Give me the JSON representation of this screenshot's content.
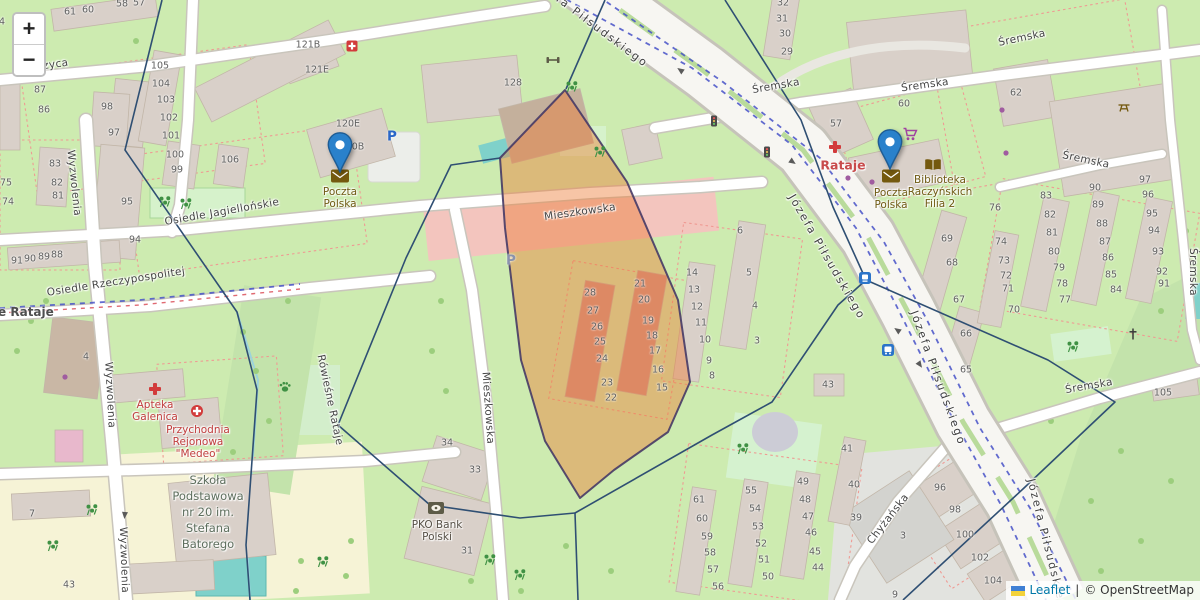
{
  "zoom_control": {
    "zoom_in": "+",
    "zoom_out": "−"
  },
  "attribution": {
    "flag_icon": "ukraine-flag-icon",
    "leaflet_link": "Leaflet",
    "separator": "|",
    "copyright": "© OpenStreetMap"
  },
  "colors": {
    "marker_blue": "#2A81CB",
    "highlight_polygon_fill": "#ed7f3a",
    "highlight_polygon_stroke": "#463a66",
    "base_green": "#cdebb0",
    "building_tan": "#d9d0c9",
    "tram_dash_blue": "#4752c8",
    "boundary_navy": "#2f4f73",
    "amenity_brown": "#6f5a13",
    "medical_red": "#c03d3d"
  },
  "markers": [
    {
      "name": "poczta-polska-marker-west",
      "label": "Poczta Polska",
      "x": 340,
      "y": 173
    },
    {
      "name": "poczta-polska-marker-east",
      "label": "Poczta Polska",
      "x": 890,
      "y": 170
    }
  ],
  "street_labels": [
    [
      "Józefa Piłsudskiego",
      590,
      22,
      37,
      "maj"
    ],
    [
      "Józefa Piłsudskiego",
      827,
      257,
      60,
      "maj"
    ],
    [
      "Józefa Piłsudskiego",
      938,
      378,
      70,
      "maj"
    ],
    [
      "Józefa Piłsudskiego",
      1048,
      548,
      76,
      "maj"
    ],
    [
      "Śremska",
      776,
      86,
      -10
    ],
    [
      "Śremska",
      925,
      85,
      -8
    ],
    [
      "Śremska",
      1022,
      38,
      -12
    ],
    [
      "Śremska",
      1086,
      160,
      12
    ],
    [
      "Śremska",
      1089,
      386,
      -10
    ],
    [
      "Śremska",
      1193,
      272,
      90
    ],
    [
      "Mieszkowska",
      580,
      212,
      -8
    ],
    [
      "Mieszkowska",
      488,
      408,
      86
    ],
    [
      "Osiedle Jagiellońskie",
      222,
      212,
      -10
    ],
    [
      "Osiedle Rzeczypospolitej",
      116,
      282,
      -9
    ],
    [
      "Wyzwolenia",
      74,
      183,
      84
    ],
    [
      "Wyzwolenia",
      110,
      395,
      87
    ],
    [
      "Wyzwolenia",
      124,
      560,
      88
    ],
    [
      "Ostrzyca",
      44,
      66,
      -8
    ],
    [
      "Chyżańska",
      888,
      519,
      -52
    ],
    [
      "Rówieśne Rataje",
      330,
      400,
      78
    ]
  ],
  "place_labels": [
    {
      "text": "Rataje",
      "x": 843,
      "y": 165,
      "cls": "suburb-red"
    },
    {
      "text": "ve Rataje",
      "x": 22,
      "y": 312,
      "cls": "suburb-gray"
    }
  ],
  "poi_labels": [
    {
      "name": "poczta-polska-label-west",
      "lines": [
        "Poczta",
        "Polska"
      ],
      "x": 340,
      "y": 186,
      "cls": "amenity"
    },
    {
      "name": "poczta-polska-label-east",
      "lines": [
        "Poczta",
        "Polska"
      ],
      "x": 891,
      "y": 187,
      "cls": "amenity"
    },
    {
      "name": "biblioteka-label",
      "lines": [
        "Biblioteka",
        "Raczyńskich",
        "Filia 2"
      ],
      "x": 940,
      "y": 174,
      "cls": "amenity"
    },
    {
      "name": "apteka-label",
      "lines": [
        "Apteka",
        "Galenica"
      ],
      "x": 155,
      "y": 399,
      "cls": "medical"
    },
    {
      "name": "przychodnia-label",
      "lines": [
        "Przychodnia",
        "Rejonowa",
        "\"Medeo\""
      ],
      "x": 198,
      "y": 424,
      "cls": "medical"
    },
    {
      "name": "pko-bank-label",
      "lines": [
        "PKO Bank",
        "Polski"
      ],
      "x": 437,
      "y": 519,
      "cls": "bank"
    },
    {
      "name": "school-label",
      "lines": [
        "Szkoła",
        "Podstawowa",
        "nr 20 im.",
        "Stefana",
        "Batorego"
      ],
      "x": 208,
      "y": 472,
      "cls": "school"
    }
  ],
  "icons": [
    {
      "type": "pharmacy",
      "name": "pharmacy-icon",
      "x": 155,
      "y": 389
    },
    {
      "type": "doctors",
      "name": "doctors-icon",
      "x": 197,
      "y": 411
    },
    {
      "type": "pharmacy",
      "name": "pharmacy-icon",
      "x": 835,
      "y": 147
    },
    {
      "type": "supermarket",
      "name": "supermarket-cart-icon",
      "x": 910,
      "y": 134
    },
    {
      "type": "library",
      "name": "library-book-icon",
      "x": 933,
      "y": 165
    },
    {
      "type": "bank",
      "name": "bank-icon",
      "x": 436,
      "y": 508
    },
    {
      "type": "post",
      "name": "post-envelope-icon",
      "x": 340,
      "y": 176
    },
    {
      "type": "post",
      "name": "post-envelope-icon",
      "x": 891,
      "y": 176
    },
    {
      "type": "tram",
      "name": "tram-stop-icon",
      "x": 865,
      "y": 278
    },
    {
      "type": "bus",
      "name": "bus-stop-icon",
      "x": 888,
      "y": 350
    },
    {
      "type": "traffic",
      "name": "traffic-light-icon",
      "x": 714,
      "y": 121
    },
    {
      "type": "traffic",
      "name": "traffic-light-icon",
      "x": 767,
      "y": 152
    },
    {
      "type": "cross",
      "name": "wayside-cross-icon",
      "x": 1133,
      "y": 334
    },
    {
      "type": "picnic",
      "name": "picnic-table-icon",
      "x": 1124,
      "y": 107
    },
    {
      "type": "fitness",
      "name": "fitness-icon",
      "x": 553,
      "y": 60
    },
    {
      "type": "redpoi",
      "name": "fire-station-icon",
      "x": 352,
      "y": 46
    },
    {
      "type": "dogpark",
      "name": "dog-park-paw-icon",
      "x": 285,
      "y": 387
    },
    {
      "type": "playground",
      "name": "playground-icon",
      "x": 165,
      "y": 202
    },
    {
      "type": "playground",
      "name": "playground-icon",
      "x": 186,
      "y": 204
    },
    {
      "type": "playground",
      "name": "playground-icon",
      "x": 600,
      "y": 152
    },
    {
      "type": "playground",
      "name": "playground-icon",
      "x": 572,
      "y": 87
    },
    {
      "type": "playground",
      "name": "playground-icon",
      "x": 92,
      "y": 510
    },
    {
      "type": "playground",
      "name": "playground-icon",
      "x": 53,
      "y": 546
    },
    {
      "type": "playground",
      "name": "playground-icon",
      "x": 743,
      "y": 449
    },
    {
      "type": "playground",
      "name": "playground-icon",
      "x": 1073,
      "y": 347
    },
    {
      "type": "playground",
      "name": "playground-icon",
      "x": 323,
      "y": 562
    },
    {
      "type": "playground",
      "name": "playground-icon",
      "x": 490,
      "y": 560
    },
    {
      "type": "playground",
      "name": "playground-icon",
      "x": 520,
      "y": 575
    },
    {
      "type": "shopdot",
      "name": "shop-dot-icon",
      "x": 848,
      "y": 178
    },
    {
      "type": "shopdot",
      "name": "shop-dot-icon",
      "x": 872,
      "y": 182
    },
    {
      "type": "shopdot",
      "name": "shop-dot-icon",
      "x": 1002,
      "y": 110
    },
    {
      "type": "shopdot",
      "name": "shop-dot-icon",
      "x": 1006,
      "y": 153
    },
    {
      "type": "shopdot",
      "name": "shop-dot-icon",
      "x": 65,
      "y": 377
    }
  ],
  "text_icons": [
    {
      "name": "parking-icon",
      "glyph": "P",
      "x": 392,
      "y": 137,
      "color": "#2a66c8"
    },
    {
      "name": "parking-icon",
      "glyph": "P",
      "x": 511,
      "y": 261,
      "color": "#8a93ad"
    }
  ],
  "building_numbers": [
    [
      "4",
      2,
      22
    ],
    [
      "61",
      70,
      12
    ],
    [
      "60",
      88,
      10
    ],
    [
      "58",
      122,
      4
    ],
    [
      "57",
      139,
      3
    ],
    [
      "87",
      40,
      90
    ],
    [
      "86",
      44,
      110
    ],
    [
      "98",
      107,
      107
    ],
    [
      "97",
      114,
      133
    ],
    [
      "105",
      160,
      66
    ],
    [
      "104",
      161,
      84
    ],
    [
      "103",
      166,
      100
    ],
    [
      "102",
      169,
      118
    ],
    [
      "101",
      171,
      136
    ],
    [
      "121B",
      308,
      45
    ],
    [
      "121E",
      317,
      70
    ],
    [
      "120E",
      348,
      124
    ],
    [
      "120B",
      352,
      147
    ],
    [
      "128",
      513,
      83
    ],
    [
      "83",
      55,
      164
    ],
    [
      "82",
      57,
      183
    ],
    [
      "81",
      58,
      196
    ],
    [
      "75",
      6,
      183
    ],
    [
      "74",
      8,
      202
    ],
    [
      "100",
      175,
      155
    ],
    [
      "99",
      177,
      170
    ],
    [
      "106",
      230,
      160
    ],
    [
      "95",
      127,
      202
    ],
    [
      "94",
      135,
      240
    ],
    [
      "91",
      17,
      261
    ],
    [
      "90",
      30,
      259
    ],
    [
      "89",
      44,
      257
    ],
    [
      "88",
      57,
      255
    ],
    [
      "7",
      32,
      514
    ],
    [
      "43",
      69,
      585
    ],
    [
      "4",
      86,
      357
    ],
    [
      "34",
      447,
      443
    ],
    [
      "33",
      475,
      470
    ],
    [
      "31",
      467,
      551
    ],
    [
      "28",
      590,
      293
    ],
    [
      "27",
      593,
      311
    ],
    [
      "26",
      597,
      327
    ],
    [
      "25",
      600,
      342
    ],
    [
      "24",
      602,
      359
    ],
    [
      "23",
      607,
      383
    ],
    [
      "22",
      611,
      398
    ],
    [
      "21",
      640,
      284
    ],
    [
      "20",
      644,
      300
    ],
    [
      "19",
      648,
      321
    ],
    [
      "18",
      652,
      336
    ],
    [
      "17",
      655,
      351
    ],
    [
      "16",
      658,
      370
    ],
    [
      "15",
      662,
      388
    ],
    [
      "14",
      692,
      273
    ],
    [
      "13",
      694,
      290
    ],
    [
      "12",
      697,
      307
    ],
    [
      "11",
      701,
      323
    ],
    [
      "10",
      705,
      340
    ],
    [
      "9",
      709,
      361
    ],
    [
      "8",
      712,
      376
    ],
    [
      "6",
      740,
      231
    ],
    [
      "5",
      749,
      273
    ],
    [
      "4",
      755,
      306
    ],
    [
      "3",
      757,
      341
    ],
    [
      "43",
      828,
      385
    ],
    [
      "61",
      699,
      500
    ],
    [
      "60",
      702,
      519
    ],
    [
      "59",
      707,
      537
    ],
    [
      "58",
      710,
      553
    ],
    [
      "57",
      713,
      570
    ],
    [
      "56",
      718,
      587
    ],
    [
      "55",
      751,
      491
    ],
    [
      "54",
      755,
      509
    ],
    [
      "53",
      758,
      527
    ],
    [
      "52",
      761,
      544
    ],
    [
      "51",
      764,
      560
    ],
    [
      "50",
      768,
      577
    ],
    [
      "49",
      803,
      482
    ],
    [
      "48",
      805,
      500
    ],
    [
      "47",
      808,
      517
    ],
    [
      "46",
      811,
      533
    ],
    [
      "45",
      815,
      552
    ],
    [
      "44",
      818,
      568
    ],
    [
      "41",
      847,
      449
    ],
    [
      "40",
      854,
      485
    ],
    [
      "39",
      856,
      518
    ],
    [
      "96",
      940,
      488
    ],
    [
      "98",
      955,
      510
    ],
    [
      "3",
      903,
      536
    ],
    [
      "100",
      965,
      535
    ],
    [
      "102",
      980,
      558
    ],
    [
      "104",
      993,
      581
    ],
    [
      "9",
      895,
      595
    ],
    [
      "69",
      947,
      239
    ],
    [
      "68",
      952,
      263
    ],
    [
      "67",
      959,
      300
    ],
    [
      "66",
      966,
      334
    ],
    [
      "65",
      966,
      370
    ],
    [
      "71",
      1008,
      289
    ],
    [
      "70",
      1014,
      310
    ],
    [
      "74",
      1001,
      242
    ],
    [
      "73",
      1004,
      261
    ],
    [
      "72",
      1006,
      276
    ],
    [
      "32",
      783,
      3
    ],
    [
      "31",
      782,
      19
    ],
    [
      "30",
      785,
      34
    ],
    [
      "29",
      787,
      52
    ],
    [
      "62",
      1016,
      93
    ],
    [
      "90",
      1095,
      188
    ],
    [
      "97",
      1145,
      180
    ],
    [
      "96",
      1148,
      195
    ],
    [
      "83",
      1046,
      196
    ],
    [
      "76",
      995,
      208
    ],
    [
      "60",
      904,
      104
    ],
    [
      "57",
      836,
      124
    ],
    [
      "82",
      1050,
      215
    ],
    [
      "81",
      1052,
      233
    ],
    [
      "80",
      1054,
      252
    ],
    [
      "79",
      1059,
      268
    ],
    [
      "78",
      1062,
      284
    ],
    [
      "77",
      1065,
      300
    ],
    [
      "89",
      1098,
      205
    ],
    [
      "88",
      1102,
      224
    ],
    [
      "87",
      1105,
      242
    ],
    [
      "86",
      1108,
      258
    ],
    [
      "85",
      1111,
      275
    ],
    [
      "84",
      1116,
      290
    ],
    [
      "95",
      1152,
      214
    ],
    [
      "94",
      1154,
      231
    ],
    [
      "93",
      1158,
      252
    ],
    [
      "92",
      1162,
      272
    ],
    [
      "91",
      1164,
      284
    ],
    [
      "105",
      1163,
      393
    ]
  ]
}
